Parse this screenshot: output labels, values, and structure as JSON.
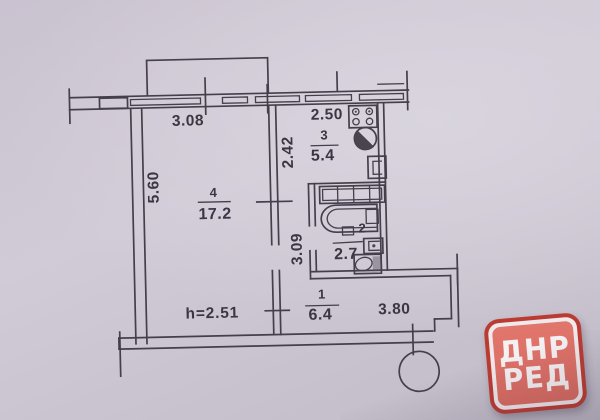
{
  "plan": {
    "dims": {
      "width_top_left": "3.08",
      "kitchen_width": "2.50",
      "kitchen_depth": "2.42",
      "living_depth": "5.60",
      "corridor_depth": "3.09",
      "hall_width": "3.80"
    },
    "ceiling_height": "h=2.51",
    "rooms": {
      "living": {
        "number": "4",
        "area": "17.2"
      },
      "kitchen": {
        "number": "3",
        "area": "5.4"
      },
      "bathroom": {
        "number": "2",
        "area": "2.7"
      },
      "hall": {
        "number": "1",
        "area": "6.4"
      }
    }
  },
  "logo": {
    "line1": "ДНР",
    "line2": "РЕД",
    "colors": {
      "border": "#bb3b32",
      "ring": "#efe9ec",
      "fill": "#dd6d63",
      "text": "#f5f0f2"
    }
  },
  "colors": {
    "paper": "#cfc9d4",
    "ink": "#453f4c"
  }
}
